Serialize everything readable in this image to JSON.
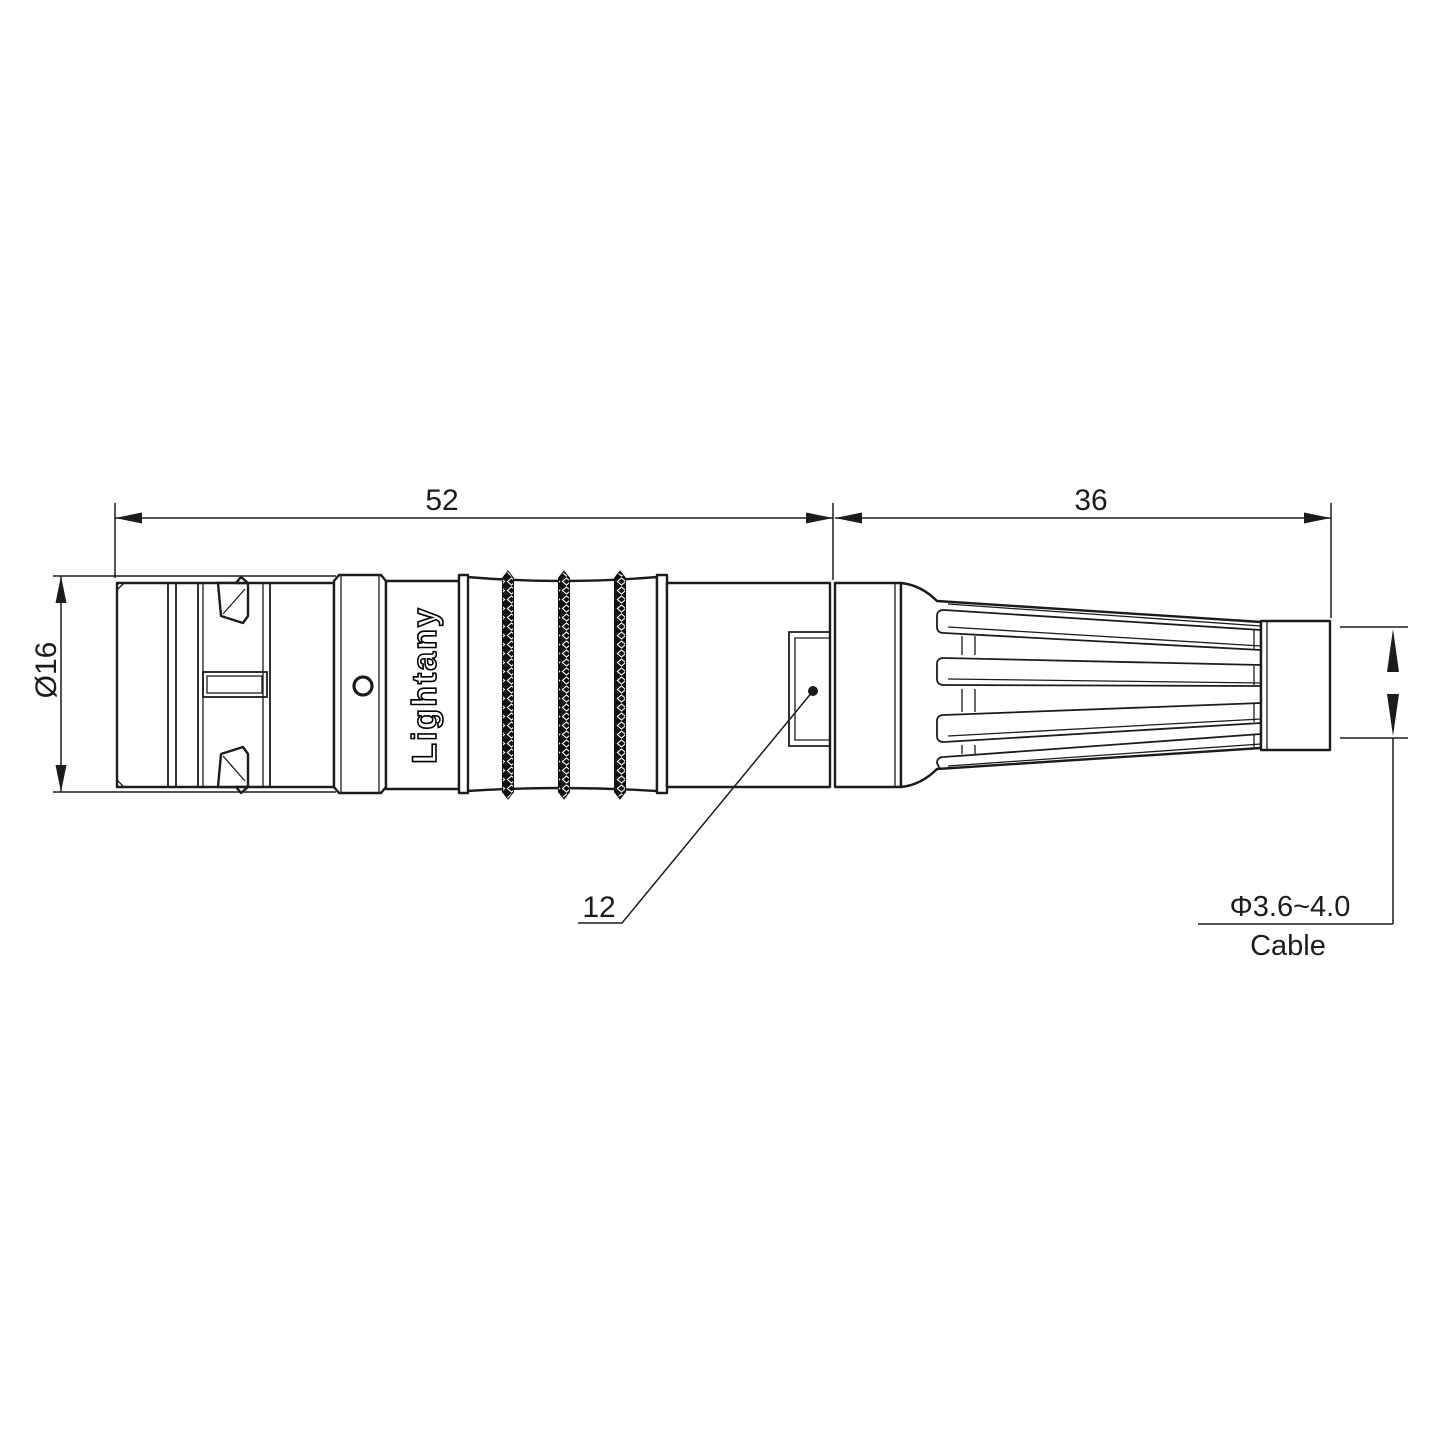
{
  "drawing": {
    "type": "connector-outline-drawing",
    "dimensions": {
      "front_length": "52",
      "rear_length": "36",
      "body_diameter": "Ø16",
      "keyway_width": "12",
      "cable_diameter": "Φ3.6~4.0",
      "cable_word": "Cable"
    },
    "branding": {
      "body_text": "Lightany",
      "watermark": "Lightany"
    },
    "colors": {
      "line": "#1c1c1c",
      "watermark": "#f3c0bd",
      "knurl_fill": "#111111"
    }
  }
}
